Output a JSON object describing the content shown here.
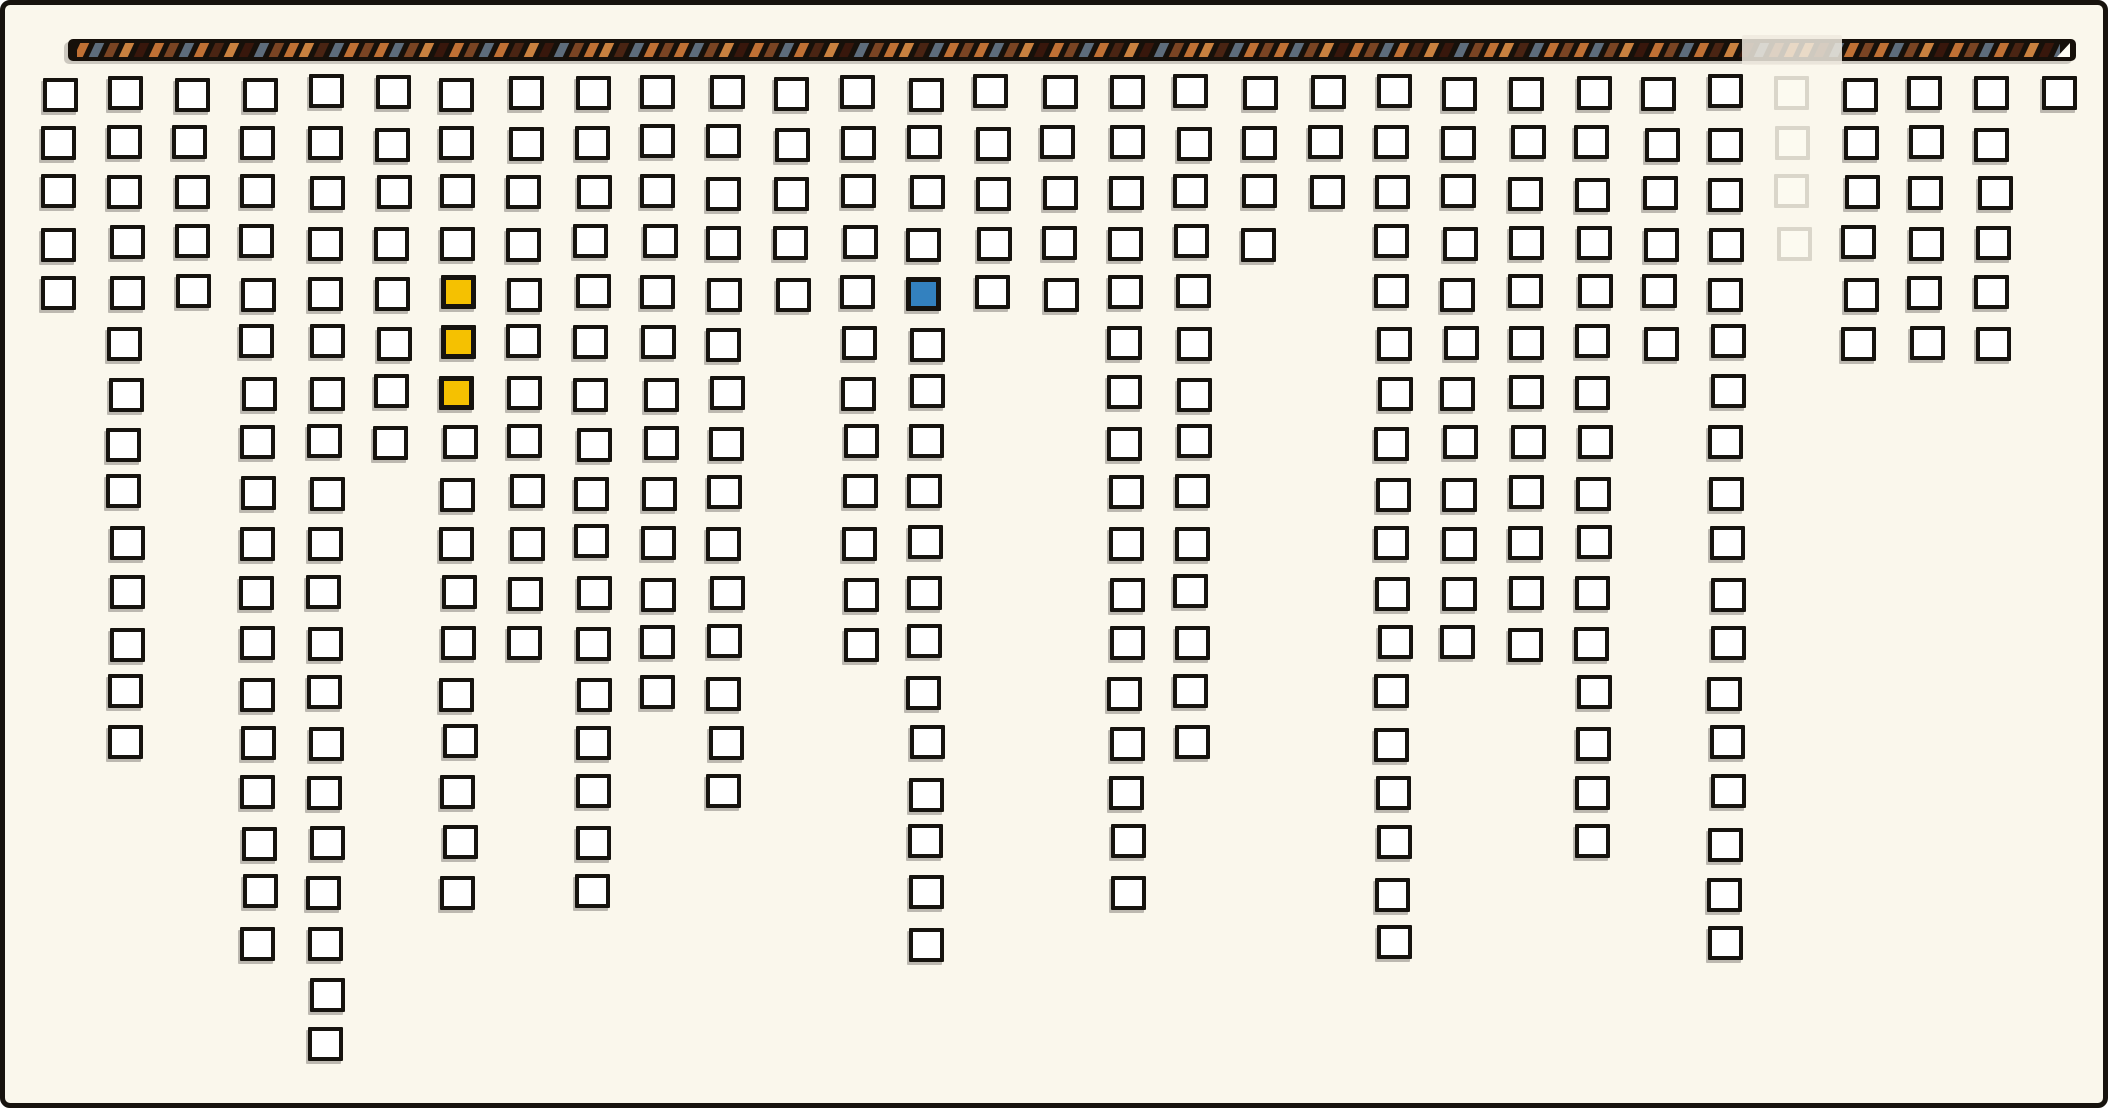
{
  "canvas": {
    "width": 2108,
    "height": 1108,
    "background_color": "#FAF7EC",
    "frame_color": "#17130E"
  },
  "timeline_bar": {
    "x": 63,
    "y": 34,
    "width": 2008,
    "height": 22,
    "background_color": "#16100A",
    "stripe_palette": {
      "orange": "#BF7034",
      "light_orange": "#C9813F",
      "slate": "#5D6C7B",
      "brown": "#7A4423",
      "dark_brown": "#4A2413",
      "maroon": "#38170C"
    },
    "stripe_sequence": [
      "orange",
      "slate",
      "brown",
      "light_orange",
      "maroon",
      "orange",
      "brown",
      "slate",
      "orange",
      "dark_brown",
      "light_orange",
      "maroon",
      "slate",
      "brown",
      "orange",
      "light_orange",
      "dark_brown",
      "slate",
      "orange",
      "brown"
    ],
    "stripe_count": 140,
    "highlight_overlay": {
      "x": 1737,
      "width": 100,
      "color": "rgba(238,234,223,0.85)"
    },
    "end_triangle_color": "#FFFDF4"
  },
  "grid": {
    "columns": 31,
    "max_rows": 20,
    "origin_x": 36,
    "origin_y": 71,
    "col_pitch": 66.73,
    "row_pitch": 50,
    "square_width": 35,
    "square_height": 34,
    "column_heights": [
      5,
      14,
      5,
      18,
      20,
      8,
      17,
      12,
      17,
      13,
      15,
      5,
      12,
      18,
      5,
      5,
      17,
      14,
      4,
      3,
      18,
      12,
      12,
      16,
      6,
      18,
      4,
      6,
      6,
      6,
      1
    ],
    "special_cells": [
      {
        "col": 6,
        "row": 5,
        "variant": "yellow"
      },
      {
        "col": 6,
        "row": 6,
        "variant": "yellow"
      },
      {
        "col": 6,
        "row": 7,
        "variant": "yellow"
      },
      {
        "col": 13,
        "row": 5,
        "variant": "blue"
      },
      {
        "col": 26,
        "row": 1,
        "variant": "faded"
      },
      {
        "col": 26,
        "row": 2,
        "variant": "faded"
      },
      {
        "col": 26,
        "row": 3,
        "variant": "faded"
      },
      {
        "col": 26,
        "row": 4,
        "variant": "faded"
      }
    ],
    "colors": {
      "default_fill": "#FFFFFF",
      "default_border": "#16130E",
      "yellow": "#F5C101",
      "blue": "#3381BF",
      "faded_border": "#DAD6CA",
      "faded_fill": "#FCFAF0"
    }
  },
  "chart_data": {
    "type": "bar",
    "orientation": "columns-hanging-from-top-bar",
    "style": "hand-drawn icicle/waffle grid of outlined squares",
    "categories": [
      1,
      2,
      3,
      4,
      5,
      6,
      7,
      8,
      9,
      10,
      11,
      12,
      13,
      14,
      15,
      16,
      17,
      18,
      19,
      20,
      21,
      22,
      23,
      24,
      25,
      26,
      27,
      28,
      29,
      30,
      31
    ],
    "values": [
      5,
      14,
      5,
      18,
      20,
      8,
      17,
      12,
      17,
      13,
      15,
      5,
      12,
      18,
      5,
      5,
      17,
      14,
      4,
      3,
      18,
      12,
      12,
      16,
      6,
      18,
      4,
      6,
      6,
      6,
      1
    ],
    "value_range": [
      1,
      20
    ],
    "highlighted_cells_1based": {
      "yellow": [
        [
          7,
          5
        ],
        [
          7,
          6
        ],
        [
          7,
          7
        ]
      ],
      "blue": [
        [
          14,
          5
        ]
      ],
      "ghost_column": {
        "column": 27,
        "rows": [
          1,
          2,
          3,
          4
        ]
      }
    },
    "top_bar_highlight_over_column_1based": 27,
    "gridlines": false,
    "axis_labels": "none visible",
    "title": ""
  }
}
